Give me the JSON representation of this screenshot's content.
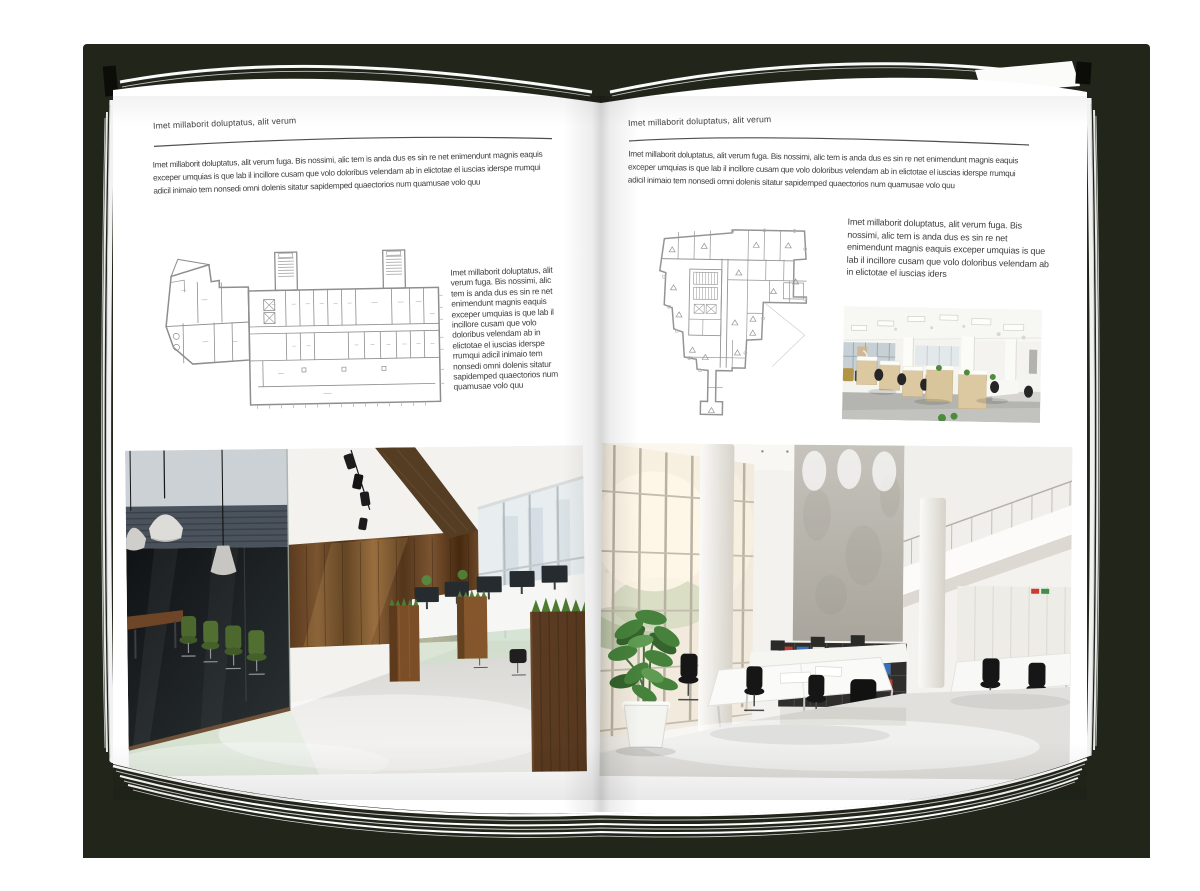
{
  "backdrop_color": "#22251a",
  "page_color": "#ffffff",
  "text_color": "#3d3d3d",
  "rule_color": "#4f4f4f",
  "left_page": {
    "header": "Imet millaborit doluptatus, alit verum",
    "intro": "Imet millaborit doluptatus, alit verum fuga. Bis nossimi, alic tem is anda dus es sin re net enimendunt magnis eaquis exceper umquias is que lab il incillore cusam que volo doloribus velendam ab in elictotae el iuscias iderspe rrumqui adicil inimaio tem nonsedi omni dolenis sitatur sapidemped quaectorios num quamusae volo quu",
    "sidebar_text": "Imet millaborit doluptatus, alit verum fuga. Bis nossimi, alic tem is anda dus es sin re net enimendunt magnis eaquis exceper umquias is que lab il incillore cusam que volo doloribus velendam ab in elictotae el iuscias iderspe rrumqui adicil inimaio tem nonsedi omni dolenis sitatur sapidemped quaectorios num quamusae volo quu"
  },
  "right_page": {
    "header": "Imet millaborit doluptatus, alit verum",
    "intro": "Imet millaborit doluptatus, alit verum fuga. Bis nossimi, alic tem is anda dus es sin re net enimendunt magnis eaquis exceper umquias is que lab il incillore cusam que volo doloribus velendam ab in elictotae el iuscias iderspe rrumqui adicil inimaio tem nonsedi omni dolenis sitatur sapidemped quaectorios num quamusae volo quu",
    "sidebar_text": "Imet millaborit doluptatus, alit verum fuga. Bis nossimi, alic tem is anda dus es sin re net enimendunt magnis eaquis exceper umquias is que lab il incillore cusam que volo doloribus velendam ab in elictotae el iuscias iders"
  }
}
